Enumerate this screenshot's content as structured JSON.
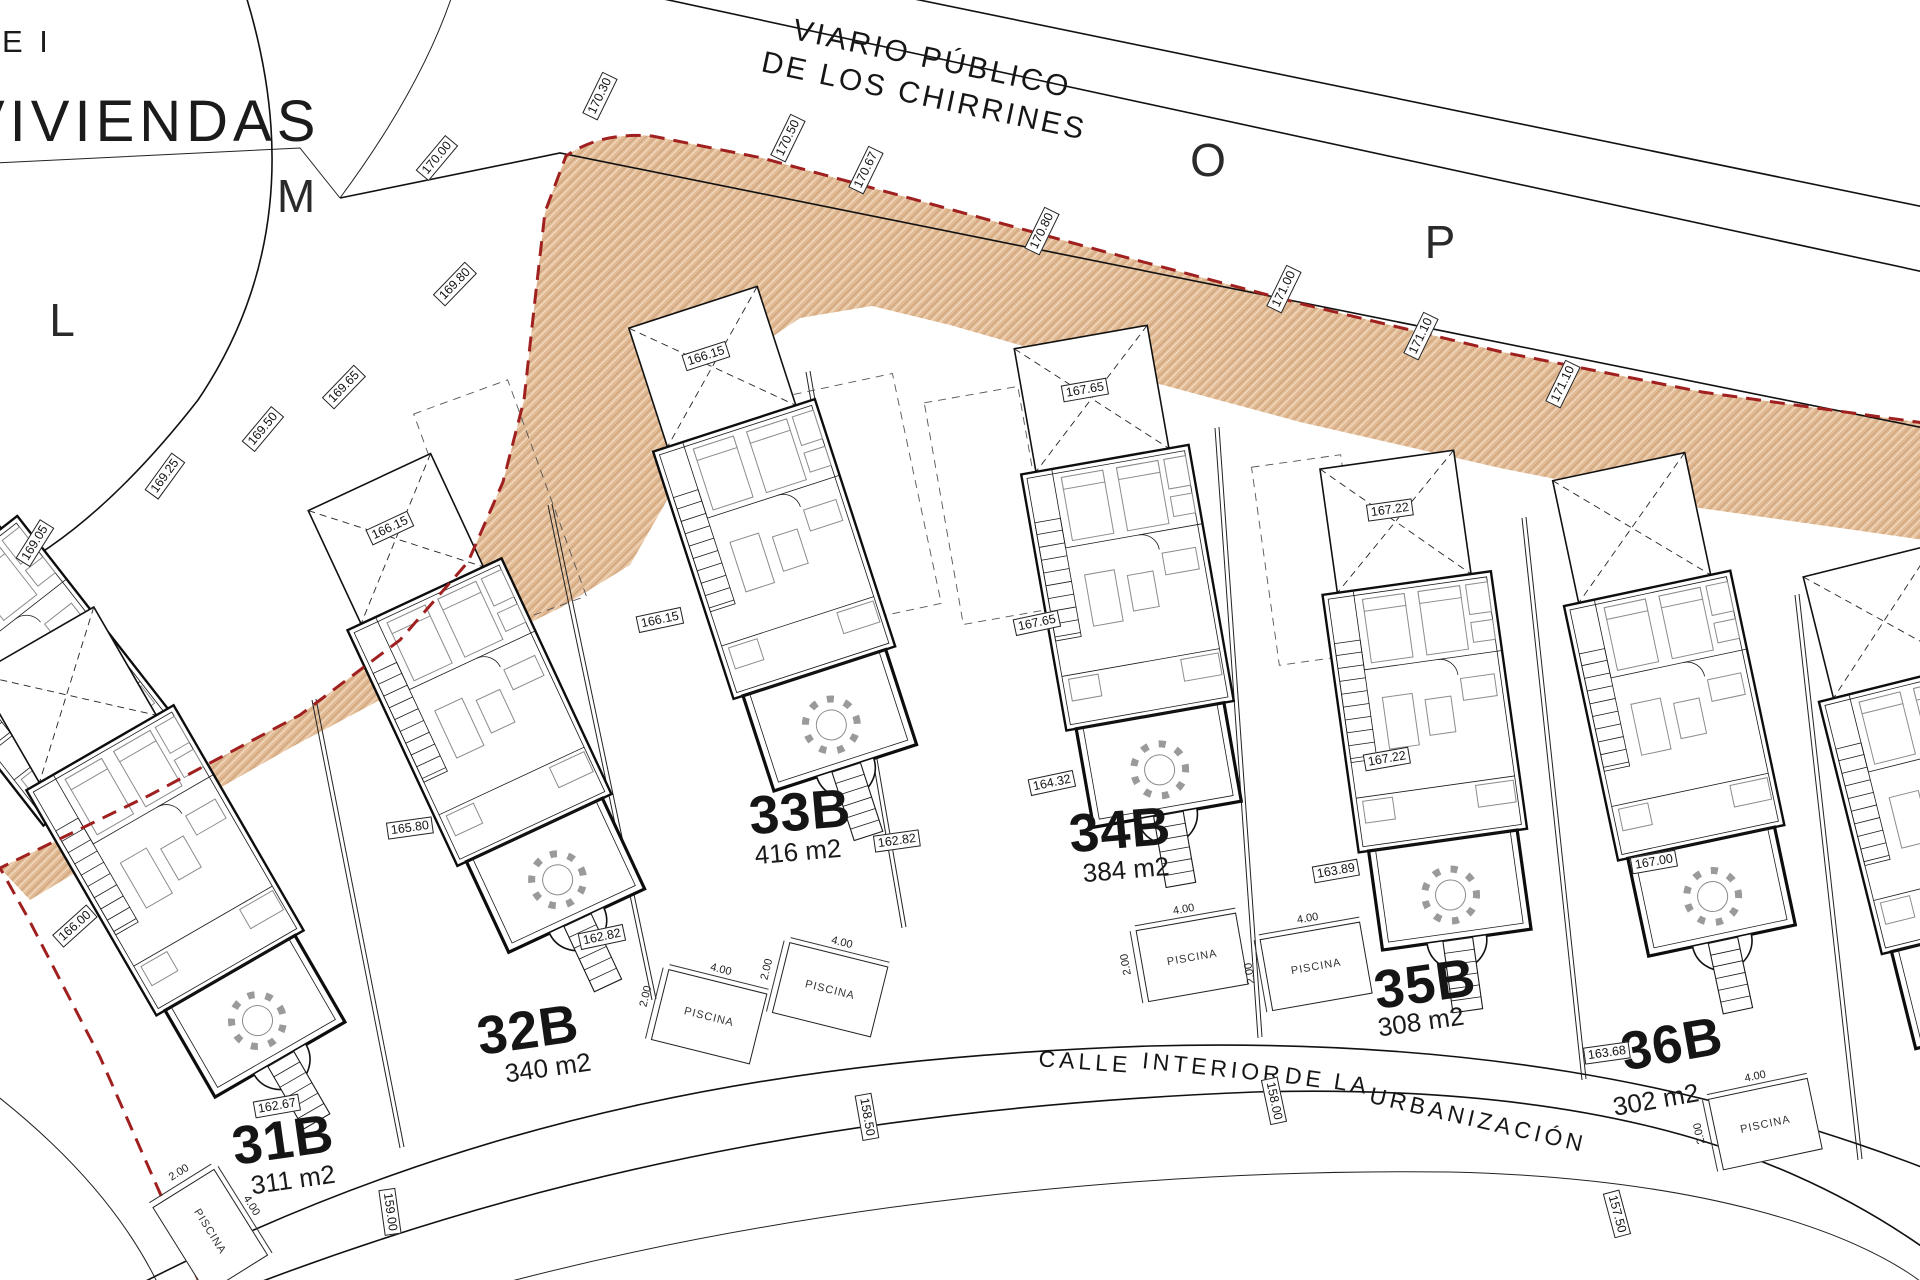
{
  "title": {
    "line1": "E I",
    "line2": "VIVIENDAS"
  },
  "roads": {
    "public_name_line1": "VIARIO PÚBLICO",
    "public_name_line2": "DE LOS CHIRRINES",
    "interior_words": [
      "CALLE",
      "INTERIOR",
      "DE",
      "LA",
      "URBANIZACIÓN"
    ]
  },
  "letters": [
    {
      "label": "L"
    },
    {
      "label": "M"
    },
    {
      "label": "O"
    },
    {
      "label": "P"
    }
  ],
  "plots": [
    {
      "label": "31B",
      "area": "311 m2"
    },
    {
      "label": "32B",
      "area": "340 m2"
    },
    {
      "label": "33B",
      "area": "416 m2"
    },
    {
      "label": "34B",
      "area": "384 m2"
    },
    {
      "label": "35B",
      "area": "308 m2"
    },
    {
      "label": "36B",
      "area": "302 m2"
    }
  ],
  "pool": {
    "label": "PISCINA",
    "width": "4.00",
    "depth": "2.00"
  },
  "markers": [
    {
      "value": "170.00"
    },
    {
      "value": "170.30"
    },
    {
      "value": "170.50"
    },
    {
      "value": "170.67"
    },
    {
      "value": "170.80"
    },
    {
      "value": "171.00"
    },
    {
      "value": "171.10"
    },
    {
      "value": "171.10"
    },
    {
      "value": "169.80"
    },
    {
      "value": "169.65"
    },
    {
      "value": "169.50"
    },
    {
      "value": "169.25"
    },
    {
      "value": "169.05"
    },
    {
      "value": "166.15"
    },
    {
      "value": "166.15"
    },
    {
      "value": "167.65"
    },
    {
      "value": "167.22"
    },
    {
      "value": "166.15"
    },
    {
      "value": "167.65"
    },
    {
      "value": "166.00"
    },
    {
      "value": "165.80"
    },
    {
      "value": "162.82"
    },
    {
      "value": "162.82"
    },
    {
      "value": "162.67"
    },
    {
      "value": "164.32"
    },
    {
      "value": "167.22"
    },
    {
      "value": "163.89"
    },
    {
      "value": "167.00"
    },
    {
      "value": "163.68"
    },
    {
      "value": "159.00"
    },
    {
      "value": "158.50"
    },
    {
      "value": "158.00"
    },
    {
      "value": "157.50"
    }
  ],
  "colors": {
    "paper": "#ffffff",
    "line": "#1a1a1a",
    "boundary_red": "#a02020",
    "hatch_fill": "#e2bb95",
    "hatch_line": "#caa27c"
  }
}
